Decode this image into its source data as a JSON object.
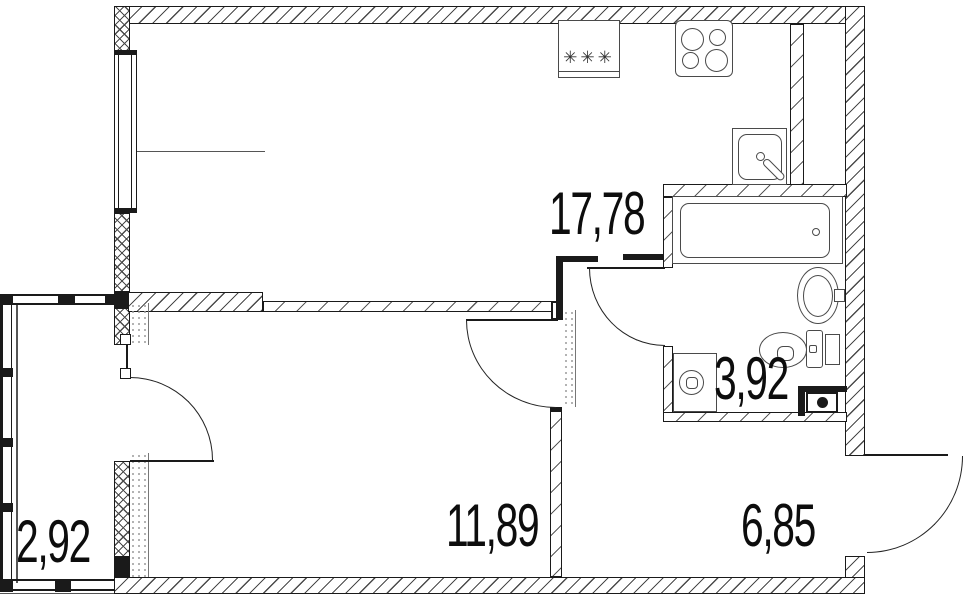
{
  "plan": {
    "kind": "apartment-floor-plan",
    "rooms": [
      {
        "id": "kitchen-living-room",
        "area": "17,78"
      },
      {
        "id": "bedroom",
        "area": "11,89"
      },
      {
        "id": "hallway",
        "area": "6,85"
      },
      {
        "id": "bathroom",
        "area": "3,92"
      },
      {
        "id": "balcony",
        "area": "2,92"
      }
    ],
    "fixtures": {
      "refrigerator_marks": "✳✳✳",
      "icons": [
        "refrigerator-icon",
        "stove-4-burner-icon",
        "kitchen-sink-icon",
        "bathtub-icon",
        "washbasin-icon",
        "toilet-icon",
        "washing-machine-icon",
        "drain-box-icon"
      ]
    },
    "colors": {
      "line": "#1a1a1a",
      "fixture_line": "#4a4a4a",
      "background": "#ffffff"
    }
  }
}
